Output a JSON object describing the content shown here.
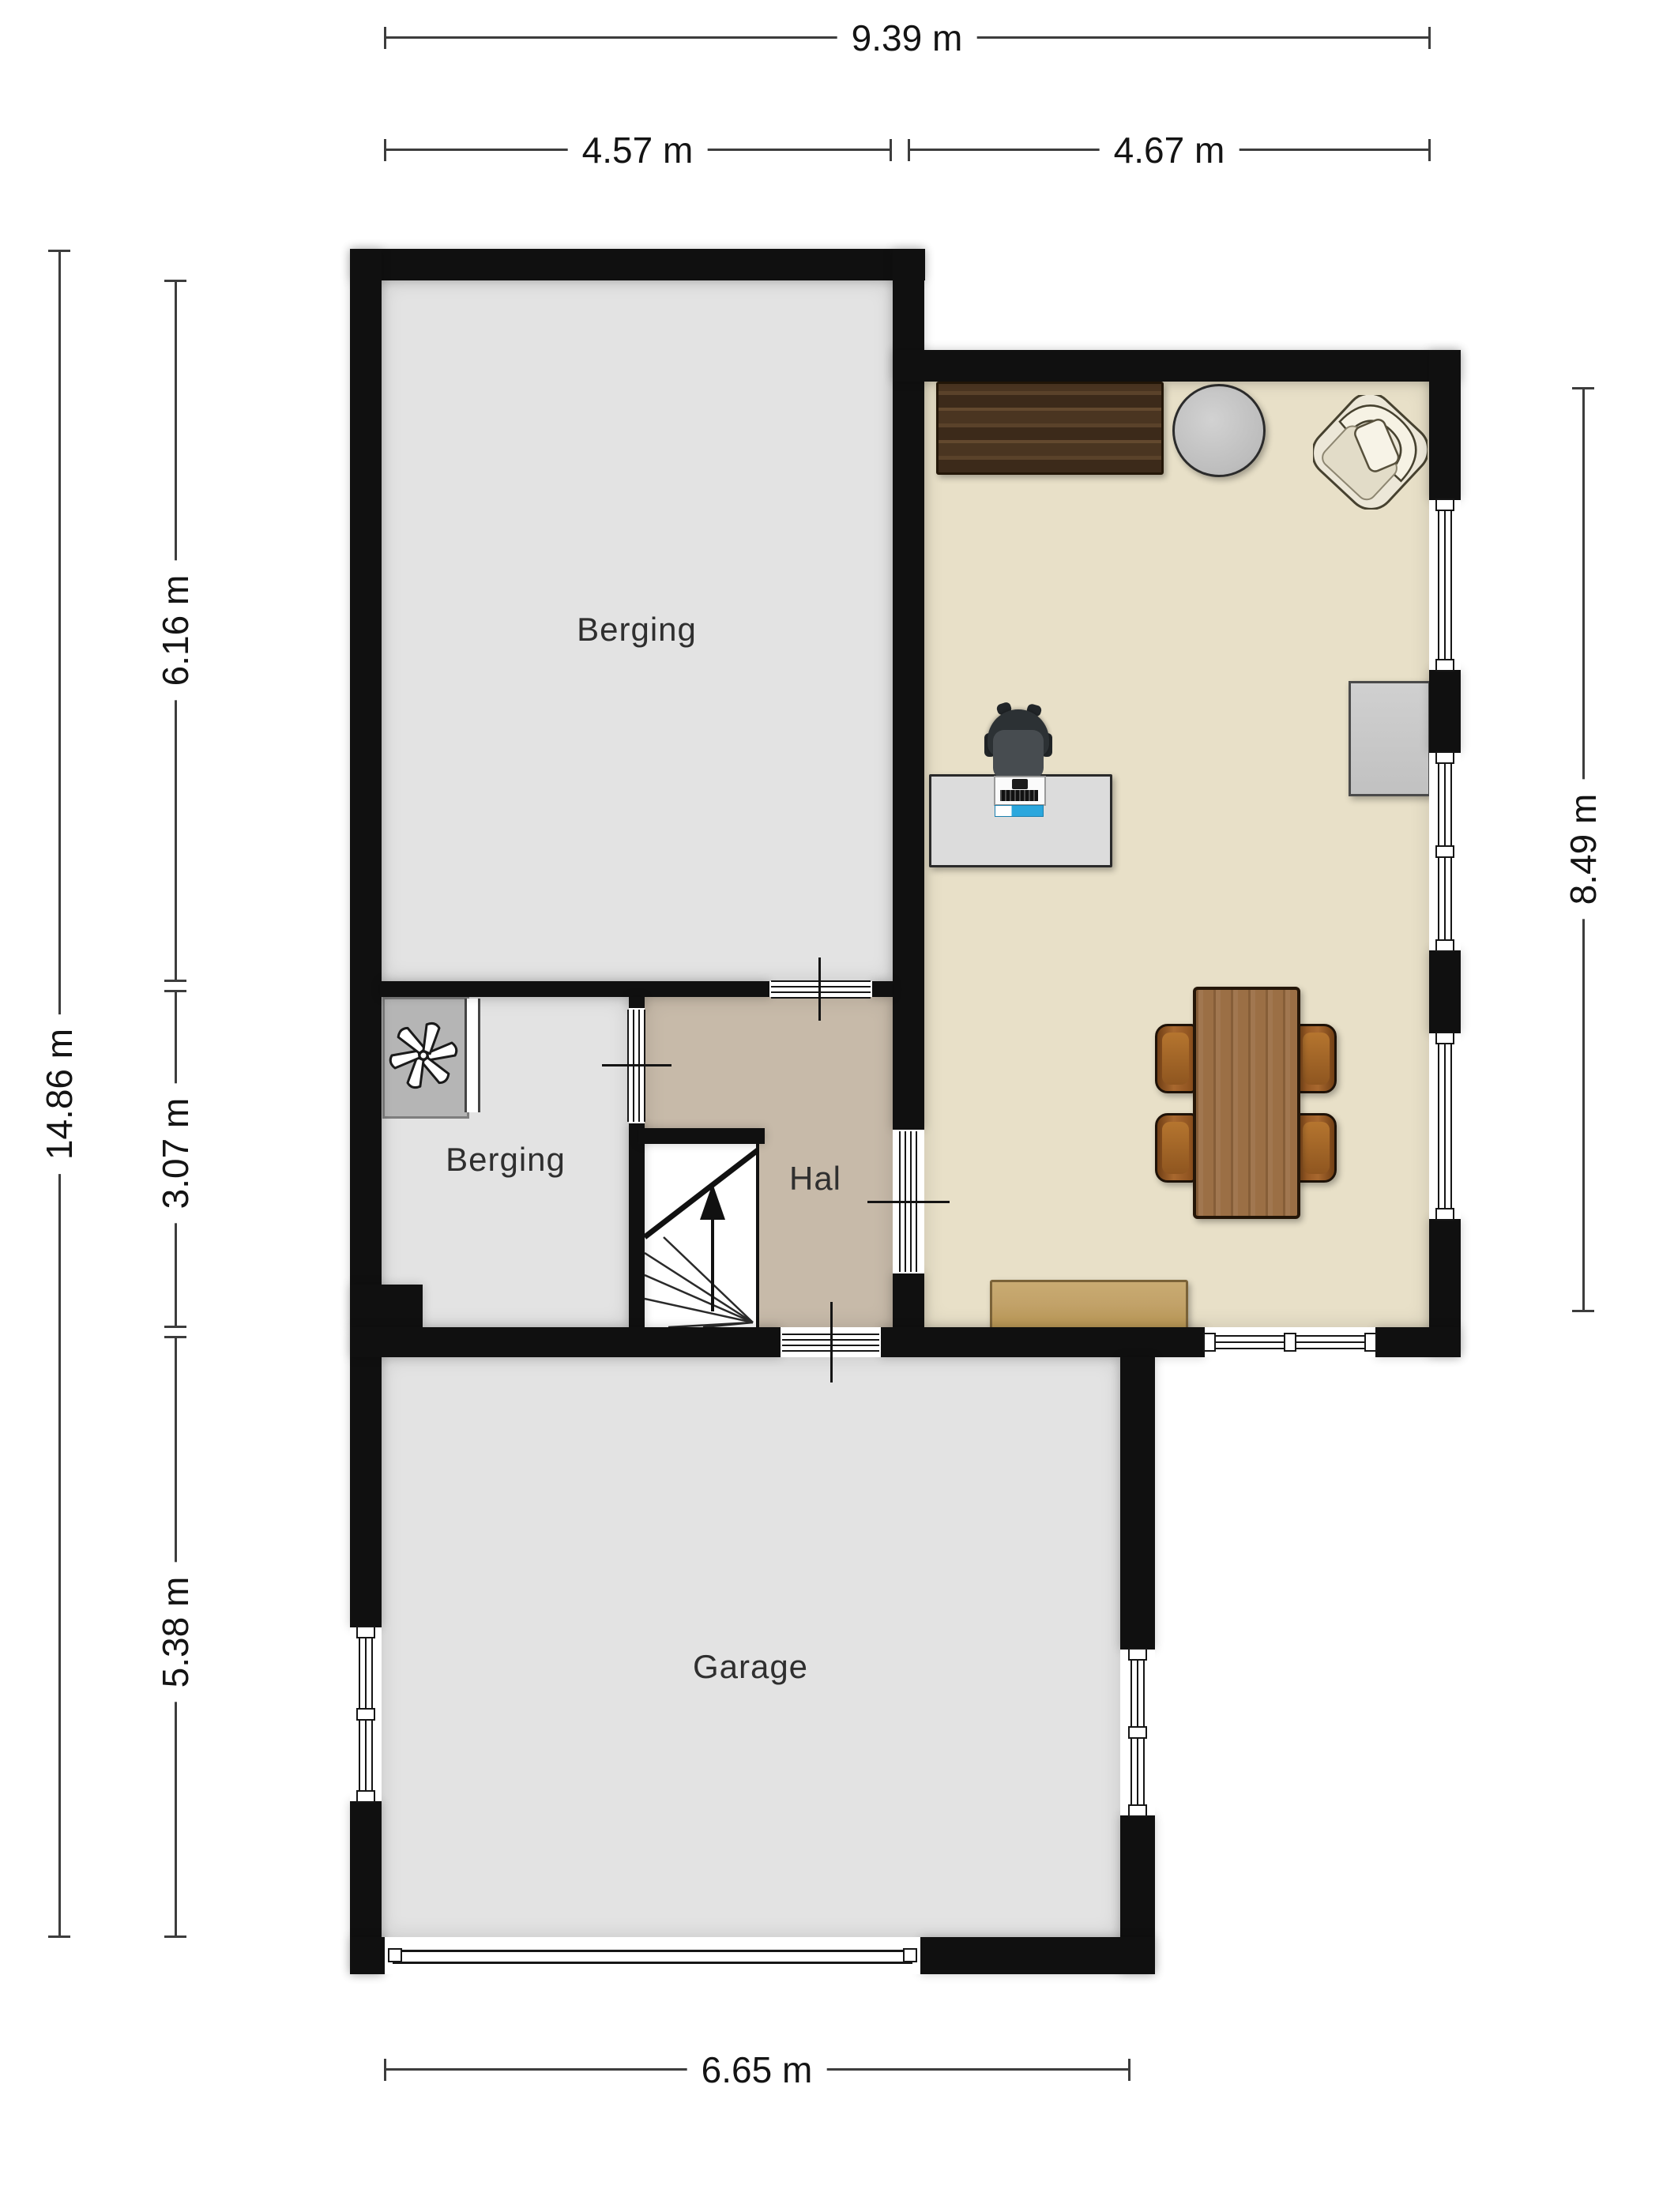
{
  "plan": {
    "title": "Floor plan ground floor",
    "dimensions": {
      "top_total": "9.39 m",
      "top_left_section": "4.57 m",
      "top_right_section": "4.67 m",
      "left_total": "14.86 m",
      "left_top": "6.16 m",
      "left_middle": "3.07 m",
      "left_bottom": "5.38 m",
      "right_side": "8.49 m",
      "bottom": "6.65 m"
    },
    "rooms": {
      "storage_top": "Berging",
      "storage_middle": "Berging",
      "hall": "Hal",
      "garage": "Garage"
    },
    "colors": {
      "wall": "#101010",
      "floor_storage": "#e3e3e3",
      "floor_hall": "#c7baa9",
      "floor_living": "#e8e0c8",
      "floor_garage": "#e3e3e3",
      "background": "#ffffff",
      "wood_dark": "#4a3521",
      "wood_table": "#9b6f45",
      "chair_leather": "#8a4f1d",
      "accent_computer": "#2ba7dd"
    },
    "icons": {
      "ventilation": "fan-icon",
      "stair_direction": "arrow-up-icon"
    }
  }
}
